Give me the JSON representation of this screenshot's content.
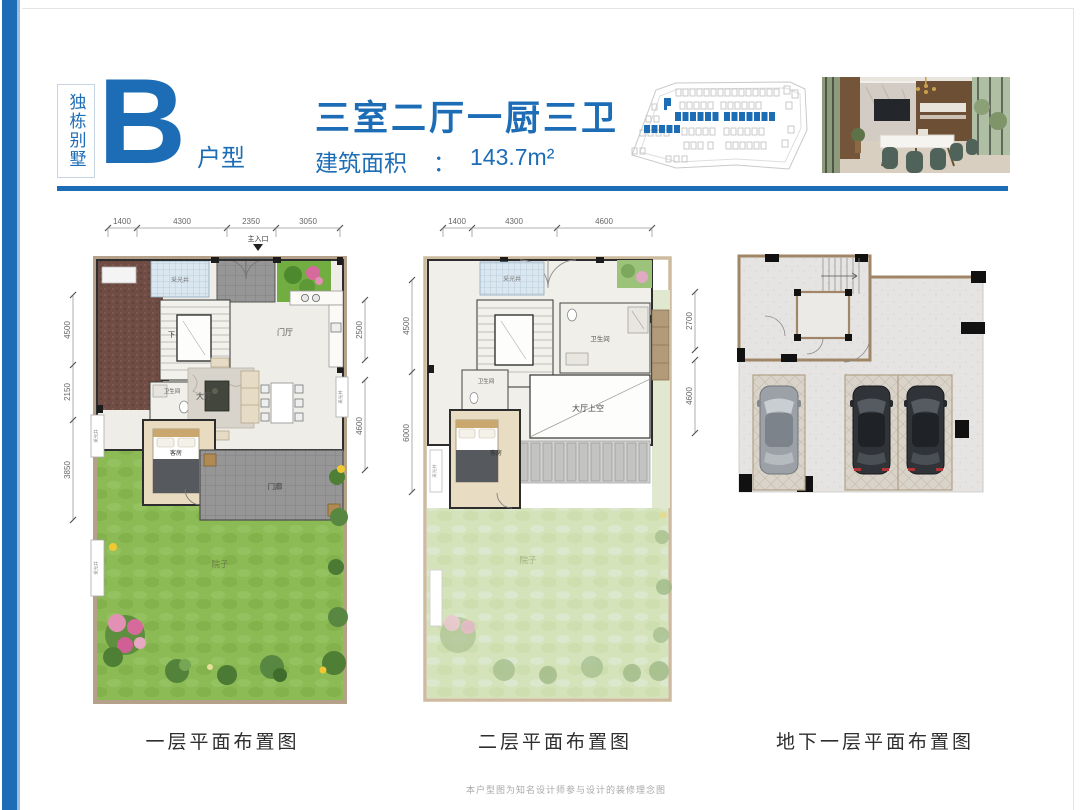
{
  "page": {
    "category_vertical": "独栋别墅",
    "unit_letter": "B",
    "unit_suffix": "户型",
    "title": "三室二厅一厨三卫",
    "area_label": "建筑面积",
    "area_colon": "：",
    "area_value": "143.7m²",
    "disclaimer": "本户型图为知名设计师参与设计的装修理念图"
  },
  "colors": {
    "accent": "#1d6db6"
  },
  "floor1": {
    "caption": "一层平面布置图",
    "entrance": "主入口",
    "dims_top": [
      "1400",
      "4300",
      "2350",
      "3050"
    ],
    "dims_left": [
      "4500",
      "2150",
      "3850"
    ],
    "dims_right": [
      "2500",
      "4600"
    ],
    "labels": {
      "lightwell": "采光井",
      "foyer": "门厅",
      "hall": "大厅",
      "bath": "卫生间",
      "bedroom": "客房",
      "porch": "门廊",
      "yard": "院子",
      "up": "上",
      "down": "下",
      "lightwell_left1": "采光井",
      "lightwell_left2": "采光井",
      "lightwell_right": "采光井"
    }
  },
  "floor2": {
    "caption": "二层平面布置图",
    "dims_top": [
      "1400",
      "4300",
      "4600"
    ],
    "dims_left": [
      "4500",
      "6000"
    ],
    "dims_right": [
      "2700",
      "4600"
    ],
    "labels": {
      "lightwell": "采光井",
      "bath": "卫生间",
      "bath2": "卫生间",
      "void": "大厅上空",
      "bedroom": "客房",
      "yard": "院子",
      "down": "下",
      "lightwell_left": "采光井"
    }
  },
  "basement": {
    "caption": "地下一层平面布置图"
  }
}
